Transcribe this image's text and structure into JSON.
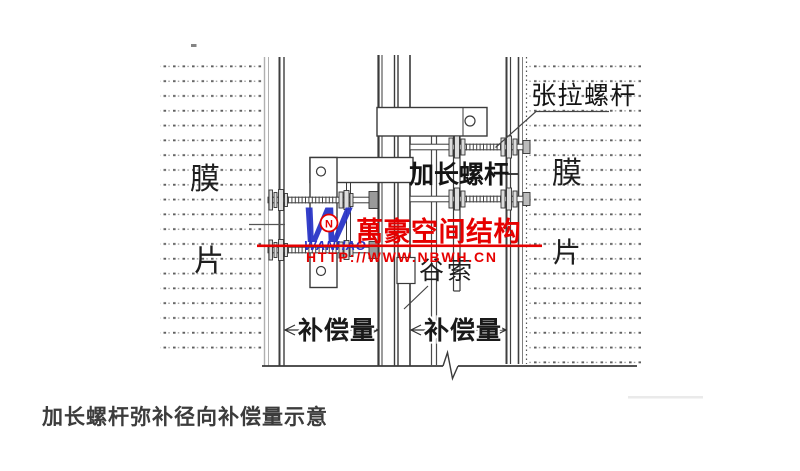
{
  "diagram": {
    "caption": "加长螺杆弥补径向补偿量示意",
    "labels": {
      "tension_bolt": "张拉螺杆",
      "extended_bolt": "加长螺杆",
      "membrane_left_top": "膜",
      "membrane_left_bottom": "片",
      "membrane_right_top": "膜",
      "membrane_right_bottom": "片",
      "valley_cable": "谷索",
      "compensation_left": "补偿量",
      "compensation_right": "补偿量"
    }
  },
  "watermark": {
    "logo_letter": "W",
    "logo_badge_letter": "N",
    "logo_name": "WANHAO",
    "company_name": "萬豪空间结构",
    "website": "HTTP://WWW.NBWH.CN",
    "brand_blue": "#2a35c8",
    "brand_red": "#e60000"
  }
}
